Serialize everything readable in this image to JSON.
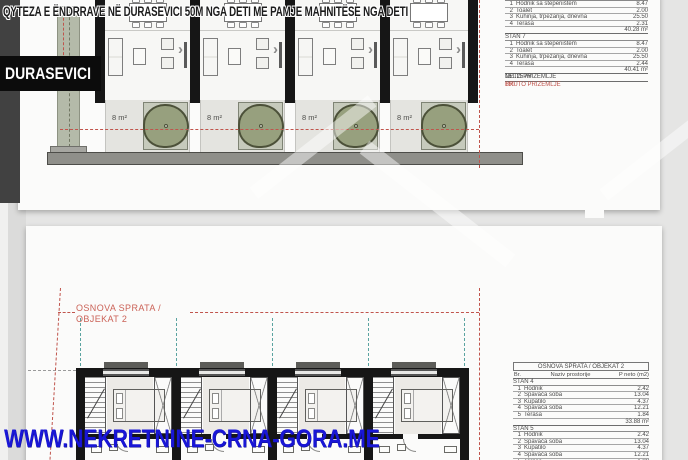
{
  "overlay": {
    "top_caption": "QYTEZA E ËNDRRAVE NË DURASEVICI 50M NGA DETI ME PAMJE MAHNITËSE NGA DETI",
    "location_label": "DURASEVICI",
    "site_watermark": "WWW.NEKRETNINE-CRNA-GORA.ME"
  },
  "ground_plan": {
    "terrace_label": "8 m²"
  },
  "floor_plan": {
    "caption_line1": "OSNOVA SPRATA /",
    "caption_line2": "OBJEKAT 2"
  },
  "ground_table": {
    "stan6_rows": [
      {
        "no": "1",
        "name": "Hodnik sa stepeništem",
        "area": "8.47"
      },
      {
        "no": "2",
        "name": "Toalet",
        "area": "2.00"
      },
      {
        "no": "3",
        "name": "Kuhinja, trpezarija, dnevna",
        "area": "25.50"
      },
      {
        "no": "4",
        "name": "Terasa",
        "area": "2.31"
      }
    ],
    "stan6_total": "40.28 m²",
    "stan7_label": "STAN 7",
    "stan7_rows": [
      {
        "no": "1",
        "name": "Hodnik sa stepeništem",
        "area": "8.47"
      },
      {
        "no": "2",
        "name": "Toalet",
        "area": "2.00"
      },
      {
        "no": "3",
        "name": "Kuhinja, trpezarija, dnevna",
        "area": "25.50"
      },
      {
        "no": "4",
        "name": "Terasa",
        "area": "2.44"
      }
    ],
    "stan7_total": "40.41 m²",
    "neto_label": "NETO PRIZEMLJE",
    "neto_value": "161.25 m²",
    "bruto_label": "BRUTO PRIZEMLJE",
    "bruto_value": "190"
  },
  "floor_table": {
    "title": "OSNOVA SPRATA / OBJEKAT 2",
    "col_no": "Br.",
    "col_name": "Naziv prostorije",
    "col_area": "P neto (m2)",
    "stan4_label": "STAN 4",
    "stan4_rows": [
      {
        "no": "1",
        "name": "Hodnik",
        "area": "2.42"
      },
      {
        "no": "2",
        "name": "Spavaća soba",
        "area": "13.04"
      },
      {
        "no": "3",
        "name": "Kupatilo",
        "area": "4.37"
      },
      {
        "no": "4",
        "name": "Spavaća soba",
        "area": "12.21"
      },
      {
        "no": "5",
        "name": "Terasa",
        "area": "1.84"
      }
    ],
    "stan4_total": "33.88 m²",
    "stan5_label": "STAN 5",
    "stan5_rows": [
      {
        "no": "1",
        "name": "Hodnik",
        "area": "2.42"
      },
      {
        "no": "2",
        "name": "Spavaća soba",
        "area": "13.04"
      },
      {
        "no": "3",
        "name": "Kupatilo",
        "area": "4.37"
      },
      {
        "no": "4",
        "name": "Spavaća soba",
        "area": "12.21"
      },
      {
        "no": "5",
        "name": "Terasa",
        "area": "1.88"
      }
    ]
  },
  "accents": {
    "boundary_red": "#c0544c",
    "caption_red": "#cb6257",
    "axis_teal": "#5aa3a0",
    "watermark_blue": "#1916d6",
    "tree_green": "#97a07e",
    "wall_black": "#161616"
  }
}
